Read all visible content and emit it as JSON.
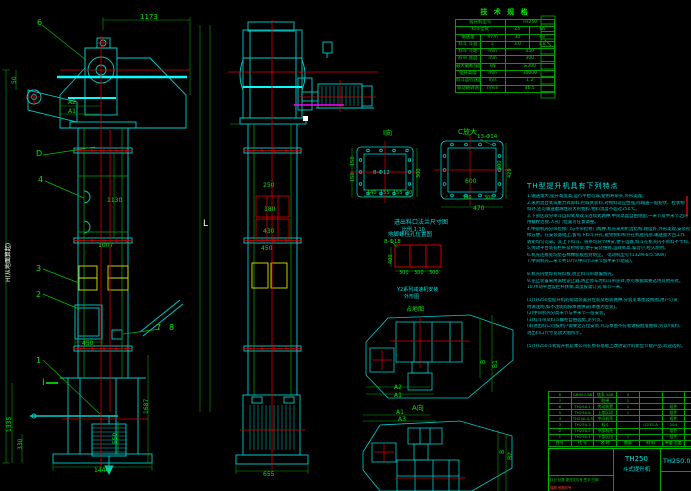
{
  "palette": {
    "g": "#00e800",
    "c": "#00dcdc",
    "w": "#ffffff",
    "r": "#ff4040",
    "y": "#ffff00"
  },
  "tech_table": {
    "title": "技 术 规 格",
    "rows": [
      [
        {
          "t": "提升机型号",
          "cs": 2
        },
        {
          "t": "TH250",
          "cs": 2
        }
      ],
      [
        {
          "t": "料斗型式",
          "cs": 2
        },
        {
          "t": "Zh",
          "cs": 1
        },
        {
          "t": "Sh",
          "cs": 1
        }
      ],
      [
        {
          "t": "输送量",
          "cs": 1
        },
        {
          "t": "m³/h",
          "cs": 1
        },
        {
          "t": "30",
          "cs": 1
        },
        {
          "t": "48",
          "cs": 1
        }
      ],
      [
        {
          "t": "料斗 斗容",
          "cs": 1
        },
        {
          "t": "L",
          "cs": 1
        },
        {
          "t": "3.0",
          "cs": 1
        },
        {
          "t": "1.8",
          "cs": 1
        }
      ],
      [
        {
          "t": "料斗 斗距",
          "cs": 1
        },
        {
          "t": "mm",
          "cs": 1
        },
        {
          "t": "450",
          "cs": 2
        }
      ],
      [
        {
          "t": "胶带 宽度",
          "cs": 1
        },
        {
          "t": "mm",
          "cs": 1
        },
        {
          "t": "300",
          "cs": 2
        }
      ],
      [
        {
          "t": "最大破断强度",
          "cs": 1
        },
        {
          "t": "kN",
          "cs": 1
        },
        {
          "t": "≥300",
          "cs": 2
        }
      ],
      [
        {
          "t": "提升高度",
          "cs": 1
        },
        {
          "t": "mm",
          "cs": 1
        },
        {
          "t": "30000",
          "cs": 2
        }
      ],
      [
        {
          "t": "料斗运行速度",
          "cs": 1
        },
        {
          "t": "m/s",
          "cs": 1
        },
        {
          "t": "1.2",
          "cs": 2
        }
      ],
      [
        {
          "t": "驱动轴转速",
          "cs": 1
        },
        {
          "t": "r/min",
          "cs": 1
        },
        {
          "t": "46.5",
          "cs": 2
        }
      ]
    ]
  },
  "features": {
    "title": "TH型提升机具有下列特点",
    "lines": [
      "1.输送量大,提升高度高,运行平稳可靠,使用寿命长,外形美观。",
      "2.采用混合式或重力式卸料,挖取式装料,对物料适应性强,除输送一般粉状、粒状物",
      "   料外,还可输送磨琢性较大的物料,物料温度不超过250℃。",
      "3.下部区段分单斗自卸式及双斗连续式两种,中间高度自由组配,一米节及半米节之间",
      "   用螺栓连接,人孔门位置可任意调整。",
      "4.中部机壳分带检修门与不带检修门两种,机壳采用折边结构,刚度好,外形美观,安装检",
      "   修方便。在安装基础上,留有下料斗开孔,避免物料积存在机座内部,输送量大且工作",
      "   转矩均匀可靠。其上下料斗、链条均分节供货,便于运输,料斗在机壳内不积料不卡料。",
      "5.传动平台装有栏杆及检修架,便于安装维修,运转率高,噪音小,经久耐用。",
      "6.机壳连接处均垫石棉橡胶板密封防尘。                电动机型号Y132M-6(5.5KW)",
      "7.中间机壳二米节共10节(中间节3米节加半米节组成)。",
      "",
      "8.机壳内壁焊有导料板,防止料斗带跑偏刮壳。",
      "9.逆止装置采用滚柱逆止器,防止停车时料斗带逆转,亦可根据需要选用其他形式。",
      "10.传动平台设栏杆扶梯,高度按需订货,每节一米。",
      "",
      "(1)TH250型提升机的驱动装置分左装及右装两种,分别见本图及附图,用户订货",
      "   时请注明,如不注明均按本图供货(本图为左装)。",
      "(2)中间机壳分高米节与半米节一层安装。",
      "(3)料斗带及料斗螺栓自由选配,见另页。",
      "(4)进出料口可按用户需要之方位安装,凡与本图不符者请按批准图样,另以Y资料,",
      "   进出料口尺寸见放大图所示。",
      "",
      "(5)TH250斗式提升机是本公司在原有基础上改进设计的新型节能产品,欢迎选购。"
    ]
  },
  "bom": {
    "headers": [
      "件号",
      "代  号",
      "名  称",
      "数量",
      "材  料",
      "单重 总重",
      "备注"
    ],
    "rows": [
      [
        "8",
        "GB907-86",
        "链条 20B",
        "4",
        "",
        "",
        ""
      ],
      [
        "7",
        "",
        "胶带",
        "1",
        "",
        "",
        ""
      ],
      [
        "6",
        "TH250.7",
        "传动装置",
        "1",
        "",
        "组件",
        ""
      ],
      [
        "5",
        "TH250.6",
        "上部区段",
        "1",
        "",
        "组件",
        ""
      ],
      [
        "4",
        "TH250.4,5",
        "中间机壳",
        "",
        "",
        "组件",
        ""
      ],
      [
        "3",
        "TH250.3",
        "料斗",
        "",
        "Q235-A",
        "204",
        ""
      ],
      [
        "2",
        "TH250.2",
        "中部机壳",
        "",
        "",
        "组件",
        ""
      ],
      [
        "1",
        "TH250.1",
        "下部区段",
        "1",
        "",
        "组件",
        ""
      ]
    ]
  },
  "title_block": {
    "model": "TH250",
    "product": "斗式提升机",
    "drawing_no": "TH250.0",
    "rev_row": "标记 处数 更改文件号 签字 日期",
    "trace_note": "描图  底图总号"
  },
  "labels": [
    {
      "t": "1173",
      "x": 140,
      "y": 14,
      "c": "g",
      "s": 7
    },
    {
      "t": "6",
      "x": 37,
      "y": 19,
      "c": "g",
      "s": 8
    },
    {
      "t": "50",
      "x": 12,
      "y": 84,
      "c": "g",
      "s": 6,
      "r": -90
    },
    {
      "t": "A2",
      "x": 68,
      "y": 100,
      "c": "g",
      "s": 6
    },
    {
      "t": "A1",
      "x": 68,
      "y": 109,
      "c": "g",
      "s": 6
    },
    {
      "t": "D",
      "x": 36,
      "y": 150,
      "c": "g",
      "s": 8
    },
    {
      "t": "4",
      "x": 38,
      "y": 176,
      "c": "g",
      "s": 8
    },
    {
      "t": "1130",
      "x": 107,
      "y": 198,
      "c": "g",
      "s": 6
    },
    {
      "t": "1007",
      "x": 98,
      "y": 243,
      "c": "g",
      "s": 6
    },
    {
      "t": "3",
      "x": 36,
      "y": 265,
      "c": "g",
      "s": 8
    },
    {
      "t": "2",
      "x": 36,
      "y": 291,
      "c": "g",
      "s": 8
    },
    {
      "t": "450",
      "x": 82,
      "y": 341,
      "c": "g",
      "s": 6
    },
    {
      "t": "7",
      "x": 156,
      "y": 324,
      "c": "g",
      "s": 8
    },
    {
      "t": "8",
      "x": 169,
      "y": 324,
      "c": "g",
      "s": 8
    },
    {
      "t": "1",
      "x": 36,
      "y": 357,
      "c": "g",
      "s": 8
    },
    {
      "t": "I",
      "x": 42,
      "y": 379,
      "c": "g",
      "s": 9
    },
    {
      "t": "H(从地面算起)",
      "x": 6,
      "y": 282,
      "c": "w",
      "s": 6,
      "r": -90
    },
    {
      "t": "1335",
      "x": 7,
      "y": 432,
      "c": "g",
      "s": 6,
      "r": -90
    },
    {
      "t": "330",
      "x": 18,
      "y": 450,
      "c": "g",
      "s": 6,
      "r": -90
    },
    {
      "t": "550",
      "x": 113,
      "y": 444,
      "c": "g",
      "s": 6,
      "r": -90
    },
    {
      "t": "1687",
      "x": 144,
      "y": 414,
      "c": "g",
      "s": 6,
      "r": -90
    },
    {
      "t": "1444",
      "x": 94,
      "y": 468,
      "c": "g",
      "s": 6
    },
    {
      "t": "L",
      "x": 203,
      "y": 220,
      "c": "w",
      "s": 9
    },
    {
      "t": "250",
      "x": 263,
      "y": 183,
      "c": "g",
      "s": 6
    },
    {
      "t": "180",
      "x": 264,
      "y": 207,
      "c": "g",
      "s": 6
    },
    {
      "t": "430",
      "x": 263,
      "y": 229,
      "c": "g",
      "s": 6
    },
    {
      "t": "450",
      "x": 261,
      "y": 246,
      "c": "g",
      "s": 6
    },
    {
      "t": "655",
      "x": 263,
      "y": 472,
      "c": "g",
      "s": 6
    },
    {
      "t": "I向",
      "x": 383,
      "y": 130,
      "c": "g",
      "s": 7
    },
    {
      "t": "8-Φ12",
      "x": 373,
      "y": 171,
      "c": "c",
      "s": 5.5
    },
    {
      "t": "150",
      "x": 351,
      "y": 166,
      "c": "g",
      "s": 5,
      "r": -90
    },
    {
      "t": "150",
      "x": 351,
      "y": 182,
      "c": "g",
      "s": 5,
      "r": -90
    },
    {
      "t": "300",
      "x": 417,
      "y": 178,
      "c": "g",
      "s": 5,
      "r": -90
    },
    {
      "t": "140",
      "x": 367,
      "y": 191,
      "c": "g",
      "s": 5
    },
    {
      "t": "155",
      "x": 380,
      "y": 191,
      "c": "g",
      "s": 5
    },
    {
      "t": "155",
      "x": 393,
      "y": 191,
      "c": "g",
      "s": 5
    },
    {
      "t": "30",
      "x": 406,
      "y": 191,
      "c": "g",
      "s": 5
    },
    {
      "t": "C放大",
      "x": 458,
      "y": 129,
      "c": "g",
      "s": 7
    },
    {
      "t": "13-Φ14",
      "x": 477,
      "y": 135,
      "c": "g",
      "s": 5.5
    },
    {
      "t": "600",
      "x": 465,
      "y": 179,
      "c": "g",
      "s": 6
    },
    {
      "t": "300",
      "x": 498,
      "y": 170,
      "c": "g",
      "s": 5,
      "r": -90
    },
    {
      "t": "420",
      "x": 508,
      "y": 178,
      "c": "g",
      "s": 5,
      "r": -90
    },
    {
      "t": "390",
      "x": 462,
      "y": 196,
      "c": "g",
      "s": 5
    },
    {
      "t": "300",
      "x": 484,
      "y": 196,
      "c": "g",
      "s": 5
    },
    {
      "t": "470",
      "x": 473,
      "y": 206,
      "c": "g",
      "s": 6
    },
    {
      "t": "进出料口法兰尺寸图",
      "x": 394,
      "y": 220,
      "c": "c",
      "s": 6
    },
    {
      "t": "比例 1:10",
      "x": 402,
      "y": 228,
      "c": "c",
      "s": 5
    },
    {
      "t": "地脚螺栓孔位置图",
      "x": 388,
      "y": 233,
      "c": "c",
      "s": 5.5
    },
    {
      "t": "8-Φ18",
      "x": 384,
      "y": 240,
      "c": "g",
      "s": 5.5
    },
    {
      "t": "400",
      "x": 389,
      "y": 264,
      "c": "g",
      "s": 5,
      "r": -90
    },
    {
      "t": "300",
      "x": 399,
      "y": 271,
      "c": "g",
      "s": 5
    },
    {
      "t": "300",
      "x": 414,
      "y": 271,
      "c": "g",
      "s": 5
    },
    {
      "t": "300",
      "x": 429,
      "y": 271,
      "c": "g",
      "s": 5
    },
    {
      "t": "Y2系列减速机安装",
      "x": 397,
      "y": 288,
      "c": "c",
      "s": 5
    },
    {
      "t": "外形图",
      "x": 404,
      "y": 295,
      "c": "c",
      "s": 5
    },
    {
      "t": "占地图",
      "x": 406,
      "y": 307,
      "c": "g",
      "s": 6
    },
    {
      "t": "A2",
      "x": 394,
      "y": 385,
      "c": "g",
      "s": 6
    },
    {
      "t": "A1",
      "x": 394,
      "y": 393,
      "c": "g",
      "s": 6
    },
    {
      "t": "B",
      "x": 481,
      "y": 364,
      "c": "g",
      "s": 6,
      "r": -90
    },
    {
      "t": "B1",
      "x": 493,
      "y": 368,
      "c": "g",
      "s": 6,
      "r": -90
    },
    {
      "t": "A向",
      "x": 412,
      "y": 405,
      "c": "g",
      "s": 7
    },
    {
      "t": "A1",
      "x": 396,
      "y": 410,
      "c": "g",
      "s": 6
    },
    {
      "t": "A3",
      "x": 398,
      "y": 417,
      "c": "g",
      "s": 6
    },
    {
      "t": "B",
      "x": 500,
      "y": 454,
      "c": "g",
      "s": 6,
      "r": -90
    },
    {
      "t": "B2",
      "x": 508,
      "y": 460,
      "c": "g",
      "s": 6,
      "r": -90
    }
  ]
}
